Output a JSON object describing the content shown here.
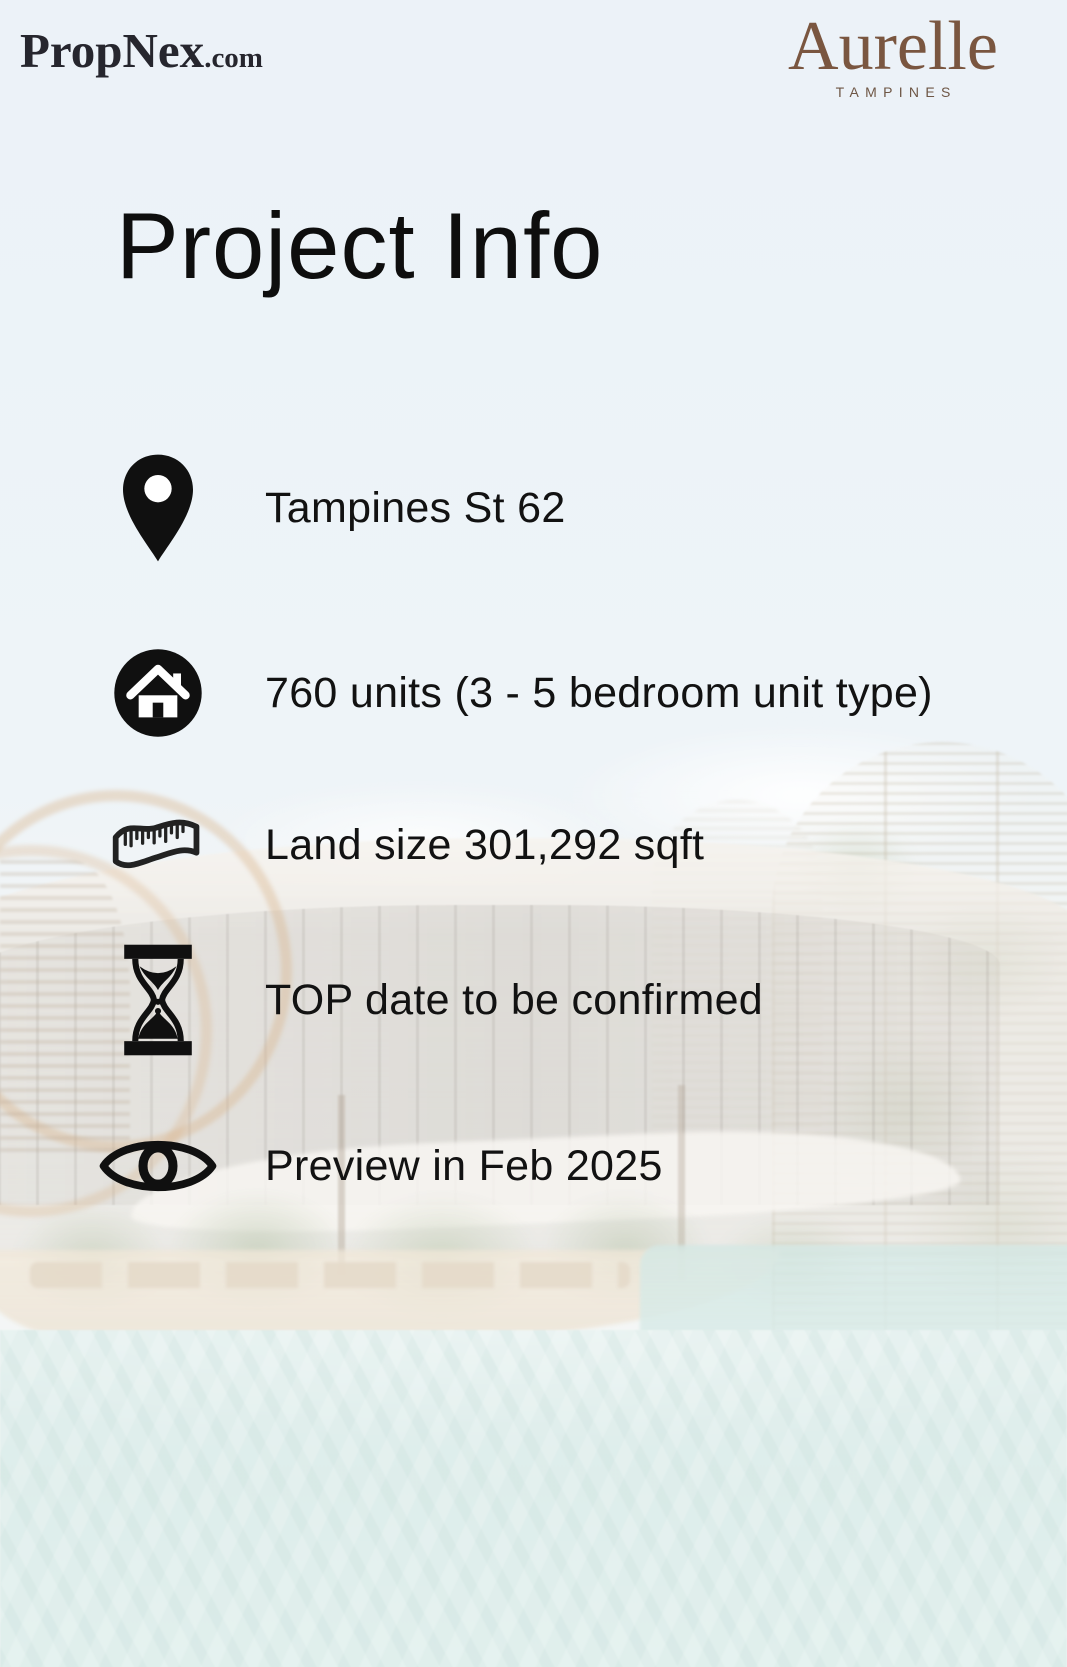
{
  "brand": {
    "propnex": {
      "name": "PropNex",
      "tld": ".com"
    },
    "aurelle": {
      "name": "Aurelle",
      "subtitle": "TAMPINES"
    }
  },
  "title": "Project Info",
  "info": {
    "items": [
      {
        "id": "location",
        "icon": "location-pin-icon",
        "text": "Tampines St 62"
      },
      {
        "id": "units",
        "icon": "home-icon",
        "text": "760 units (3 - 5 bedroom unit type)"
      },
      {
        "id": "land-size",
        "icon": "measuring-tape-icon",
        "text": "Land size 301,292 sqft"
      },
      {
        "id": "top-date",
        "icon": "hourglass-icon",
        "text": "TOP date to be confirmed"
      },
      {
        "id": "preview",
        "icon": "eye-icon",
        "text": "Preview in Feb 2025"
      }
    ]
  },
  "colors": {
    "aurelle_brown": "#7a5640",
    "propnex_dark": "#26262e",
    "text": "#121212",
    "sky": "#e2ecf4",
    "pool_teal": "#cde4e1",
    "deck_sand": "#e6d8c2",
    "icon_black": "#101010"
  }
}
